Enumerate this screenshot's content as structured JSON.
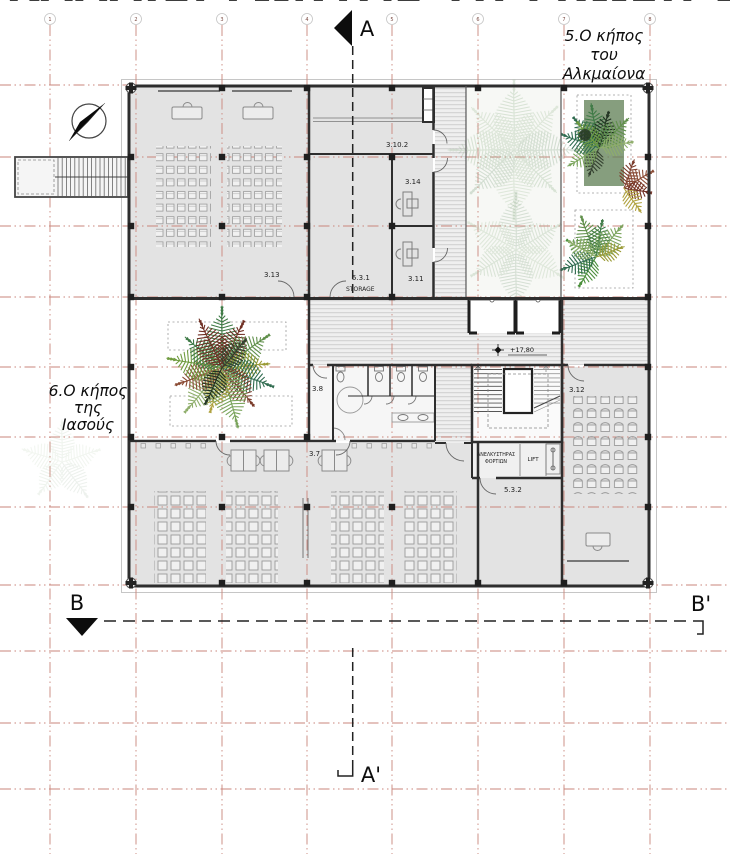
{
  "title_fragment": "ΚΑΛΛΙΕΡΓΩΝΤΑΣ ΤΗ ΓΝΩΣΗ ΣΤΗΝ ΑΚΑΔΗΜΙΑ ΠΛΑΤΩΝΟΣ",
  "grid": {
    "numbers": [
      "1",
      "2",
      "3",
      "4",
      "5",
      "6",
      "7",
      "8"
    ]
  },
  "sections": {
    "a": "A",
    "a_prime": "A'",
    "b": "B",
    "b_prime": "B'"
  },
  "gardens": {
    "garden5": {
      "line1": "5.Ο κήπος",
      "line2": "του",
      "line3": "Αλκμαίονα"
    },
    "garden6": {
      "line1": "6.Ο κήπος",
      "line2": "της",
      "line3": "Ιασούς"
    }
  },
  "rooms": {
    "r313": "3.13",
    "r3102": "3.10.2",
    "r314": "3.14",
    "r311": "3.11",
    "r531": "5.3.1",
    "storage": "STORAGE",
    "r532": "5.3.2",
    "r312": "3.12",
    "r38": "3.8",
    "r37": "3.7"
  },
  "annotations": {
    "level": "+17,80",
    "freight_lift_line1": "ΑΝΕΛΚΥΣΤΗΡΑΣ",
    "freight_lift_line2": "ΦΟΡΤΙΩΝ",
    "lift": "LIFT"
  },
  "colors": {
    "grid_line": "#c9857b",
    "wall": "#2e2e2e",
    "room_fill": "#e3e3e3",
    "hatch_fill": "#efefef",
    "hatch_line": "#cfcfcf",
    "planter_green": "#64835a",
    "fern_greens": [
      "#3f7a46",
      "#5f8f4a",
      "#7aa45c",
      "#8fae6b",
      "#2f6b4f",
      "#6f9b3f",
      "#4a8f3a"
    ],
    "fern_reds": [
      "#6f2f23",
      "#7a3b2a",
      "#8a4a33"
    ],
    "fern_olives": [
      "#9a9a35",
      "#b0a23f"
    ],
    "fern_darks": [
      "#233423",
      "#33402f"
    ],
    "fern_faint": [
      "#9ab894",
      "#aac4a2",
      "#8aa88a"
    ]
  }
}
